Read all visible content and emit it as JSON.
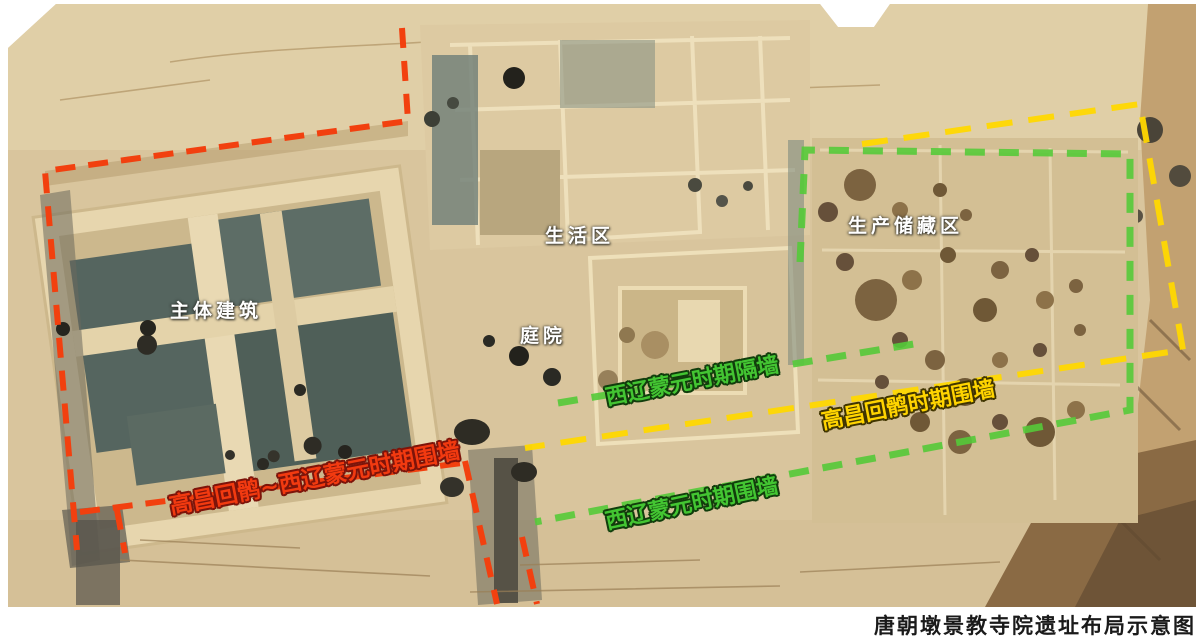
{
  "caption": "唐朝墩景教寺院遗址布局示意图",
  "area_labels": {
    "main_building": "主体建筑",
    "living_area": "生活区",
    "courtyard": "庭院",
    "production_storage": "生产储藏区"
  },
  "wall_labels": {
    "red_wall": "高昌回鹘~西辽蒙元时期围墙",
    "yellow_wall": "高昌回鹘时期围墙",
    "green_partition": "西辽蒙元时期隔墙",
    "green_wall": "西辽蒙元时期围墙"
  },
  "colors": {
    "red_wall_line": "#f2400f",
    "yellow_wall_line": "#ffd800",
    "green_wall_line": "#55ca39",
    "area_label_text": "#ffffff",
    "caption_text": "#1a1a1a",
    "sand_base": "#d9c59d"
  }
}
